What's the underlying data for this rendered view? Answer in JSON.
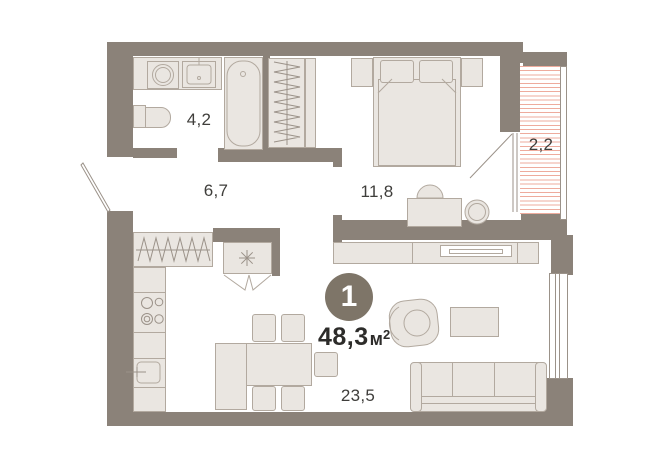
{
  "floorplan": {
    "badge": {
      "rooms_count": "1",
      "area_value": "48,3",
      "area_unit": "м",
      "area_sup": "2"
    },
    "rooms": {
      "bathroom": {
        "area": "4,2"
      },
      "hallway": {
        "area": "6,7"
      },
      "bedroom": {
        "area": "11,8"
      },
      "balcony": {
        "area": "2,2"
      },
      "living_kitchen": {
        "area": "23,5"
      }
    },
    "colors": {
      "wall": "#8b8279",
      "furniture": "#eae6e1",
      "stroke": "#b2a99f",
      "frame": "#9b9289",
      "hatch": "#eeab9d",
      "label": "#3f3e3b",
      "badge_bg": "#7e7568",
      "badge_text": "#ffffff",
      "area_text": "#2d2c2a"
    }
  }
}
